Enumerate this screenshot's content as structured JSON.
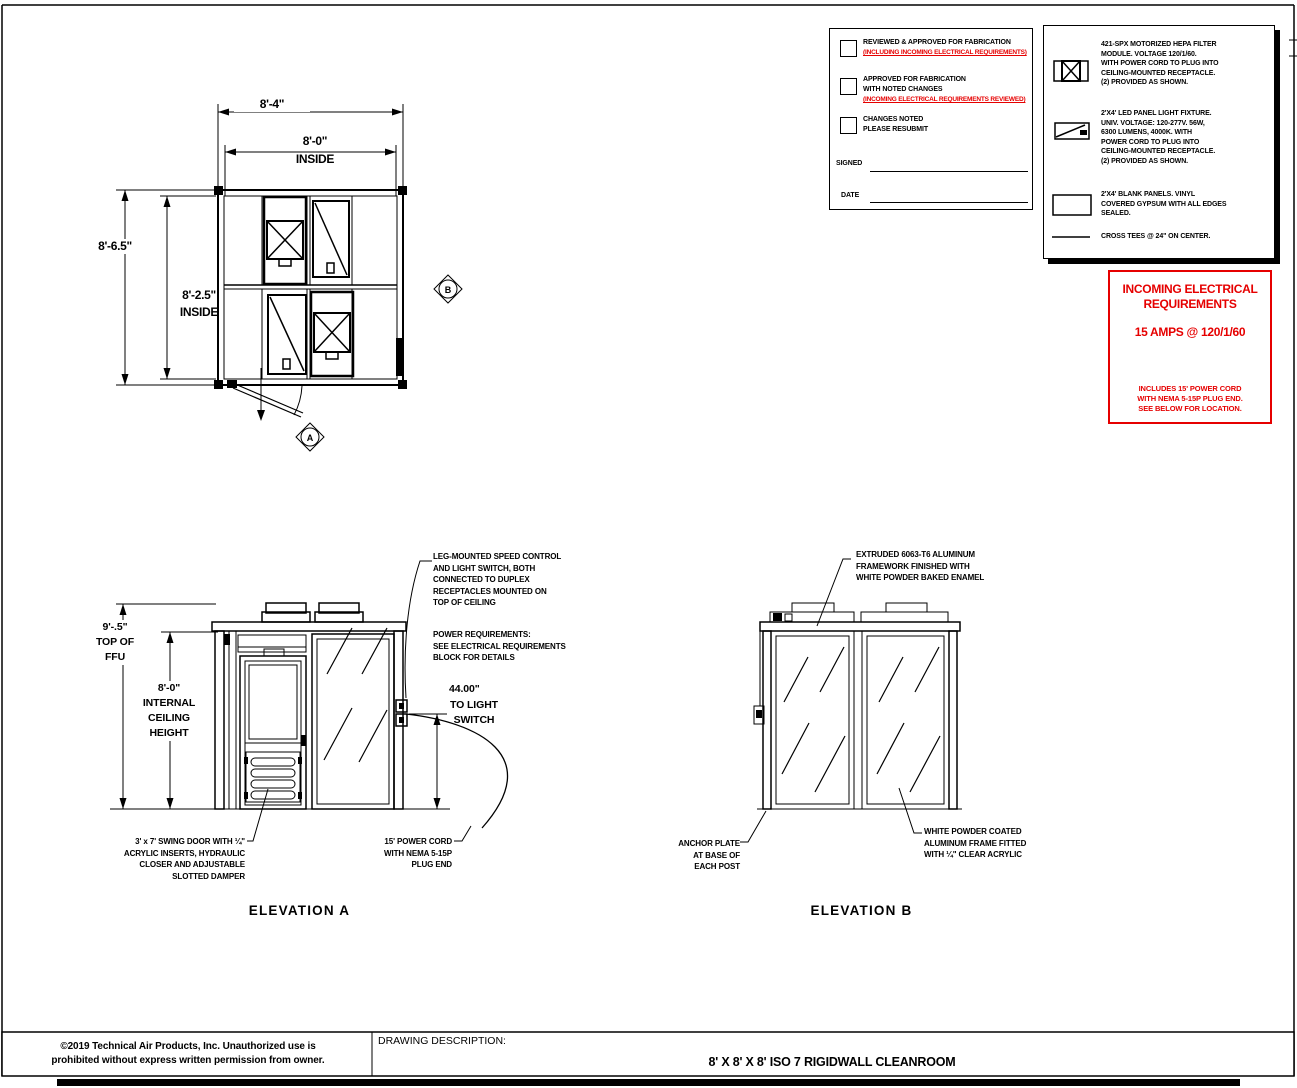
{
  "colors": {
    "line": "#000000",
    "accent_red": "#e60000",
    "paper": "#ffffff"
  },
  "page": {
    "copyright": "©2019 Technical Air Products, Inc.  Unauthorized use is\nprohibited without express written permission from owner.",
    "description_label": "DRAWING DESCRIPTION:",
    "description": "8' X 8' X 8' ISO 7 RIGIDWALL CLEANROOM"
  },
  "approval": {
    "items": [
      {
        "label": "REVIEWED & APPROVED FOR FABRICATION",
        "note": "(INCLUDING INCOMING ELECTRICAL REQUIREMENTS)"
      },
      {
        "label": "APPROVED FOR FABRICATION\nWITH NOTED CHANGES",
        "note": "(INCOMING ELECTRICAL REQUIREMENTS REVIEWED)"
      },
      {
        "label": "CHANGES NOTED\nPLEASE RESUBMIT",
        "note": ""
      }
    ],
    "signed_label": "SIGNED",
    "date_label": "DATE"
  },
  "legend": {
    "items": [
      {
        "icon": "hepa-filter-symbol",
        "text": "421-SPX  MOTORIZED HEPA FILTER\nMODULE. VOLTAGE 120/1/60.\nWITH POWER CORD TO PLUG INTO\nCEILING-MOUNTED RECEPTACLE.\n(2) PROVIDED AS SHOWN."
      },
      {
        "icon": "led-panel-symbol",
        "text": "2'X4' LED PANEL LIGHT FIXTURE.\nUNIV. VOLTAGE: 120-277V.  56W,\n6300 LUMENS, 4000K. WITH\nPOWER CORD TO PLUG INTO\nCEILING-MOUNTED RECEPTACLE.\n(2) PROVIDED AS SHOWN."
      },
      {
        "icon": "blank-panel-symbol",
        "text": "2'X4' BLANK PANELS. VINYL\nCOVERED GYPSUM WITH ALL EDGES\nSEALED."
      },
      {
        "icon": "cross-tee-symbol",
        "text": "CROSS TEES @ 24\" ON CENTER."
      }
    ]
  },
  "electrical": {
    "title": "INCOMING ELECTRICAL\nREQUIREMENTS",
    "rating": "15 AMPS @ 120/1/60",
    "note": "INCLUDES 15' POWER CORD\nWITH NEMA 5-15P PLUG END.\nSEE BELOW FOR LOCATION."
  },
  "plan": {
    "dim_width_outer": "8'-4\"",
    "dim_width_inner": "8'-0\"",
    "dim_width_inner_suffix": "INSIDE",
    "dim_height_outer": "8'-6.5\"",
    "dim_height_inner": "8'-2.5\"",
    "dim_height_inner_suffix": "INSIDE",
    "marker_a": "A",
    "marker_b": "B"
  },
  "elevation_a": {
    "title": "ELEVATION A",
    "note_switch": "LEG-MOUNTED SPEED CONTROL\nAND LIGHT SWITCH, BOTH\nCONNECTED TO DUPLEX\nRECEPTACLES MOUNTED ON\nTOP OF CEILING",
    "note_power": "POWER REQUIREMENTS:\nSEE ELECTRICAL REQUIREMENTS\nBLOCK FOR DETAILS",
    "dim_light_switch_value": "44.00\"",
    "dim_light_switch_label": "TO LIGHT\nSWITCH",
    "dim_ffu": "9'-.5\"\nTOP OF\nFFU",
    "dim_ceiling": "8'-0\"\nINTERNAL\nCEILING\nHEIGHT",
    "note_door": "3' x 7' SWING DOOR WITH ¼\"\nACRYLIC INSERTS, HYDRAULIC\nCLOSER AND ADJUSTABLE\nSLOTTED DAMPER",
    "note_cord": "15' POWER CORD\nWITH NEMA 5-15P\nPLUG END"
  },
  "elevation_b": {
    "title": "ELEVATION B",
    "note_frame": "EXTRUDED 6063-T6 ALUMINUM\nFRAMEWORK FINISHED WITH\nWHITE POWDER BAKED ENAMEL",
    "note_anchor": "ANCHOR PLATE\nAT BASE OF\nEACH POST",
    "note_acrylic": "WHITE POWDER COATED\nALUMINUM FRAME FITTED\nWITH ¼\" CLEAR ACRYLIC"
  }
}
